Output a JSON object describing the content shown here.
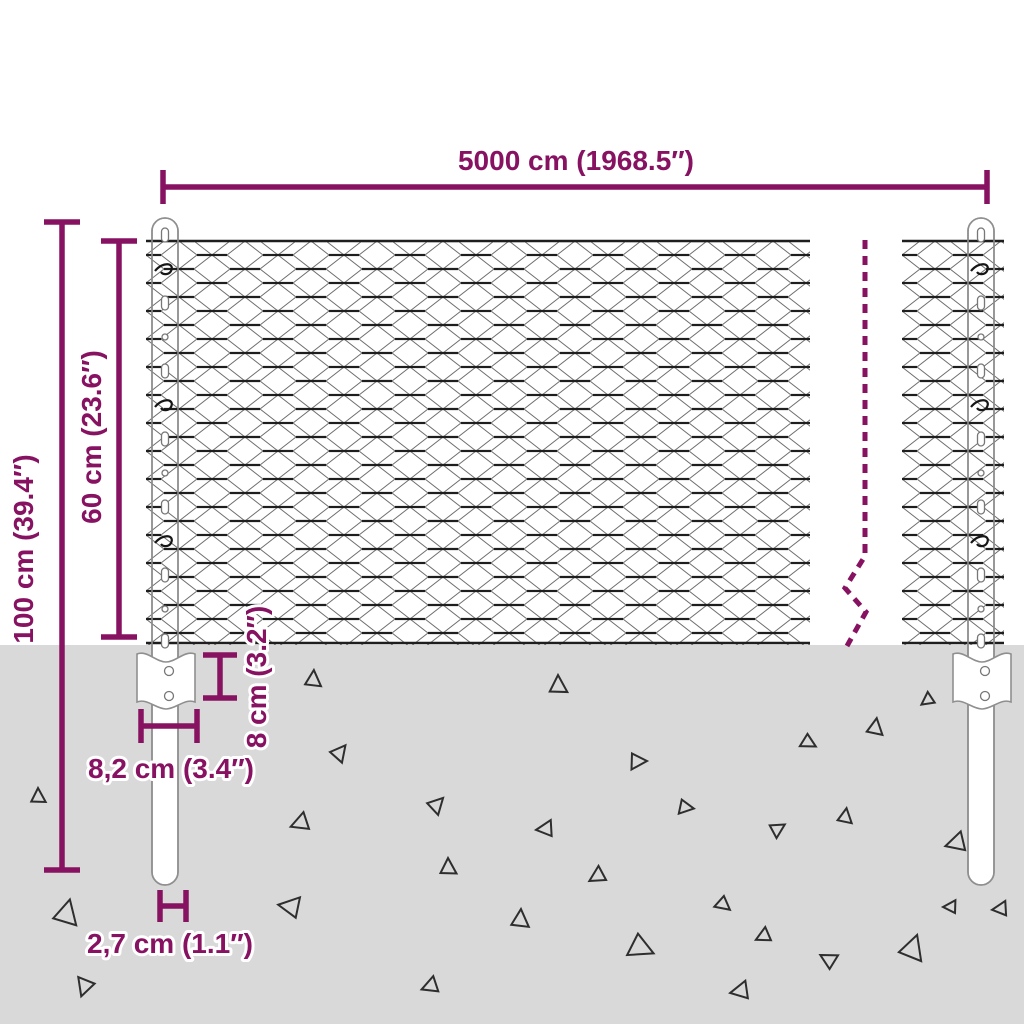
{
  "colors": {
    "accent": "#871261",
    "ground": "#d9d9d9",
    "wire": "#6e6e6e",
    "wire_dark": "#1e1e1e",
    "post_outline": "#8f8f8f",
    "triangle": "#2e2e2e"
  },
  "dimensions": {
    "fence_length": "5000 cm (1968.5″)",
    "total_height": "100 cm (39.4″)",
    "mesh_height": "60 cm (23.6″)",
    "bracket_height": "8 cm (3.2″)",
    "bracket_width": "8,2 cm (3.4″)",
    "post_diameter": "2,7 cm (1.1″)"
  },
  "ground_triangles": [
    {
      "x": 38,
      "y": 797,
      "s": 9,
      "r": 0
    },
    {
      "x": 66,
      "y": 914,
      "s": 15,
      "r": 15
    },
    {
      "x": 85,
      "y": 986,
      "s": 11,
      "r": 200
    },
    {
      "x": 313,
      "y": 680,
      "s": 10,
      "r": 5
    },
    {
      "x": 558,
      "y": 686,
      "s": 11,
      "r": 0
    },
    {
      "x": 339,
      "y": 753,
      "s": 10,
      "r": 40
    },
    {
      "x": 637,
      "y": 761,
      "s": 10,
      "r": 90
    },
    {
      "x": 808,
      "y": 742,
      "s": 9,
      "r": 120
    },
    {
      "x": 875,
      "y": 728,
      "s": 10,
      "r": 10
    },
    {
      "x": 436,
      "y": 805,
      "s": 10,
      "r": 45
    },
    {
      "x": 685,
      "y": 807,
      "s": 9,
      "r": 100
    },
    {
      "x": 301,
      "y": 823,
      "s": 11,
      "r": 250
    },
    {
      "x": 546,
      "y": 829,
      "s": 10,
      "r": 265
    },
    {
      "x": 777,
      "y": 829,
      "s": 9,
      "r": 60
    },
    {
      "x": 845,
      "y": 817,
      "s": 9,
      "r": 10
    },
    {
      "x": 957,
      "y": 843,
      "s": 12,
      "r": 255
    },
    {
      "x": 448,
      "y": 868,
      "s": 10,
      "r": 0
    },
    {
      "x": 598,
      "y": 876,
      "s": 10,
      "r": 240
    },
    {
      "x": 291,
      "y": 907,
      "s": 13,
      "r": 280
    },
    {
      "x": 520,
      "y": 920,
      "s": 11,
      "r": 5
    },
    {
      "x": 723,
      "y": 904,
      "s": 9,
      "r": 130
    },
    {
      "x": 640,
      "y": 947,
      "s": 15,
      "r": 115
    },
    {
      "x": 764,
      "y": 936,
      "s": 9,
      "r": 245
    },
    {
      "x": 829,
      "y": 960,
      "s": 10,
      "r": 300
    },
    {
      "x": 912,
      "y": 949,
      "s": 15,
      "r": 20
    },
    {
      "x": 951,
      "y": 907,
      "s": 8,
      "r": 270
    },
    {
      "x": 431,
      "y": 986,
      "s": 10,
      "r": 250
    },
    {
      "x": 741,
      "y": 991,
      "s": 11,
      "r": 260
    },
    {
      "x": 928,
      "y": 700,
      "s": 8,
      "r": 235
    },
    {
      "x": 1001,
      "y": 909,
      "s": 9,
      "r": 265
    }
  ]
}
